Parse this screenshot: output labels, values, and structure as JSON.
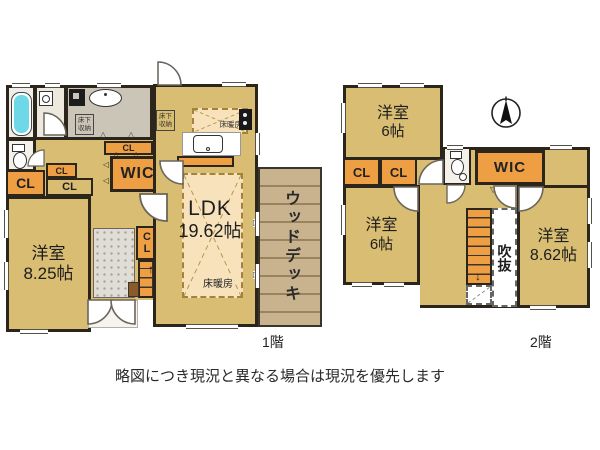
{
  "caption": "略図につき現況と異なる場合は現況を優先します",
  "colors": {
    "floor": "#d8bd72",
    "closet": "#ee9f44",
    "wall": "#2b251c",
    "heating": "#f7e2bc",
    "bath": "#6fd8e8",
    "deck": "#c9b28e",
    "tile": "#e0ddd6"
  },
  "icons": {
    "arrow_up": "↑",
    "arrow_down": "↓",
    "tri_up": "△",
    "tri_down": "▽",
    "tri_left": "◁",
    "tri_right": "▷"
  },
  "floor1": {
    "label": "1階",
    "ldk": {
      "name": "LDK",
      "size": "19.62帖"
    },
    "bedroom": {
      "name": "洋室",
      "size": "8.25帖"
    },
    "wic": "WIC",
    "closet_big": "CL",
    "closet_small": "CL",
    "closet_wide": "CL",
    "closet_top": "CL",
    "closet_stairs": "CL",
    "heating_living": "床暖房",
    "heating_kitchen": "床暖房",
    "underfloor_left": "床下収納",
    "underfloor_kitchen": "床下収納",
    "wood_deck": "ウッドデッキ"
  },
  "floor2": {
    "label": "2階",
    "bedroom_top": {
      "name": "洋室",
      "size": "6帖"
    },
    "bedroom_mid": {
      "name": "洋室",
      "size": "6帖"
    },
    "bedroom_right": {
      "name": "洋室",
      "size": "8.62帖"
    },
    "closet_a": "CL",
    "closet_b": "CL",
    "wic": "WIC",
    "void": "吹抜"
  }
}
